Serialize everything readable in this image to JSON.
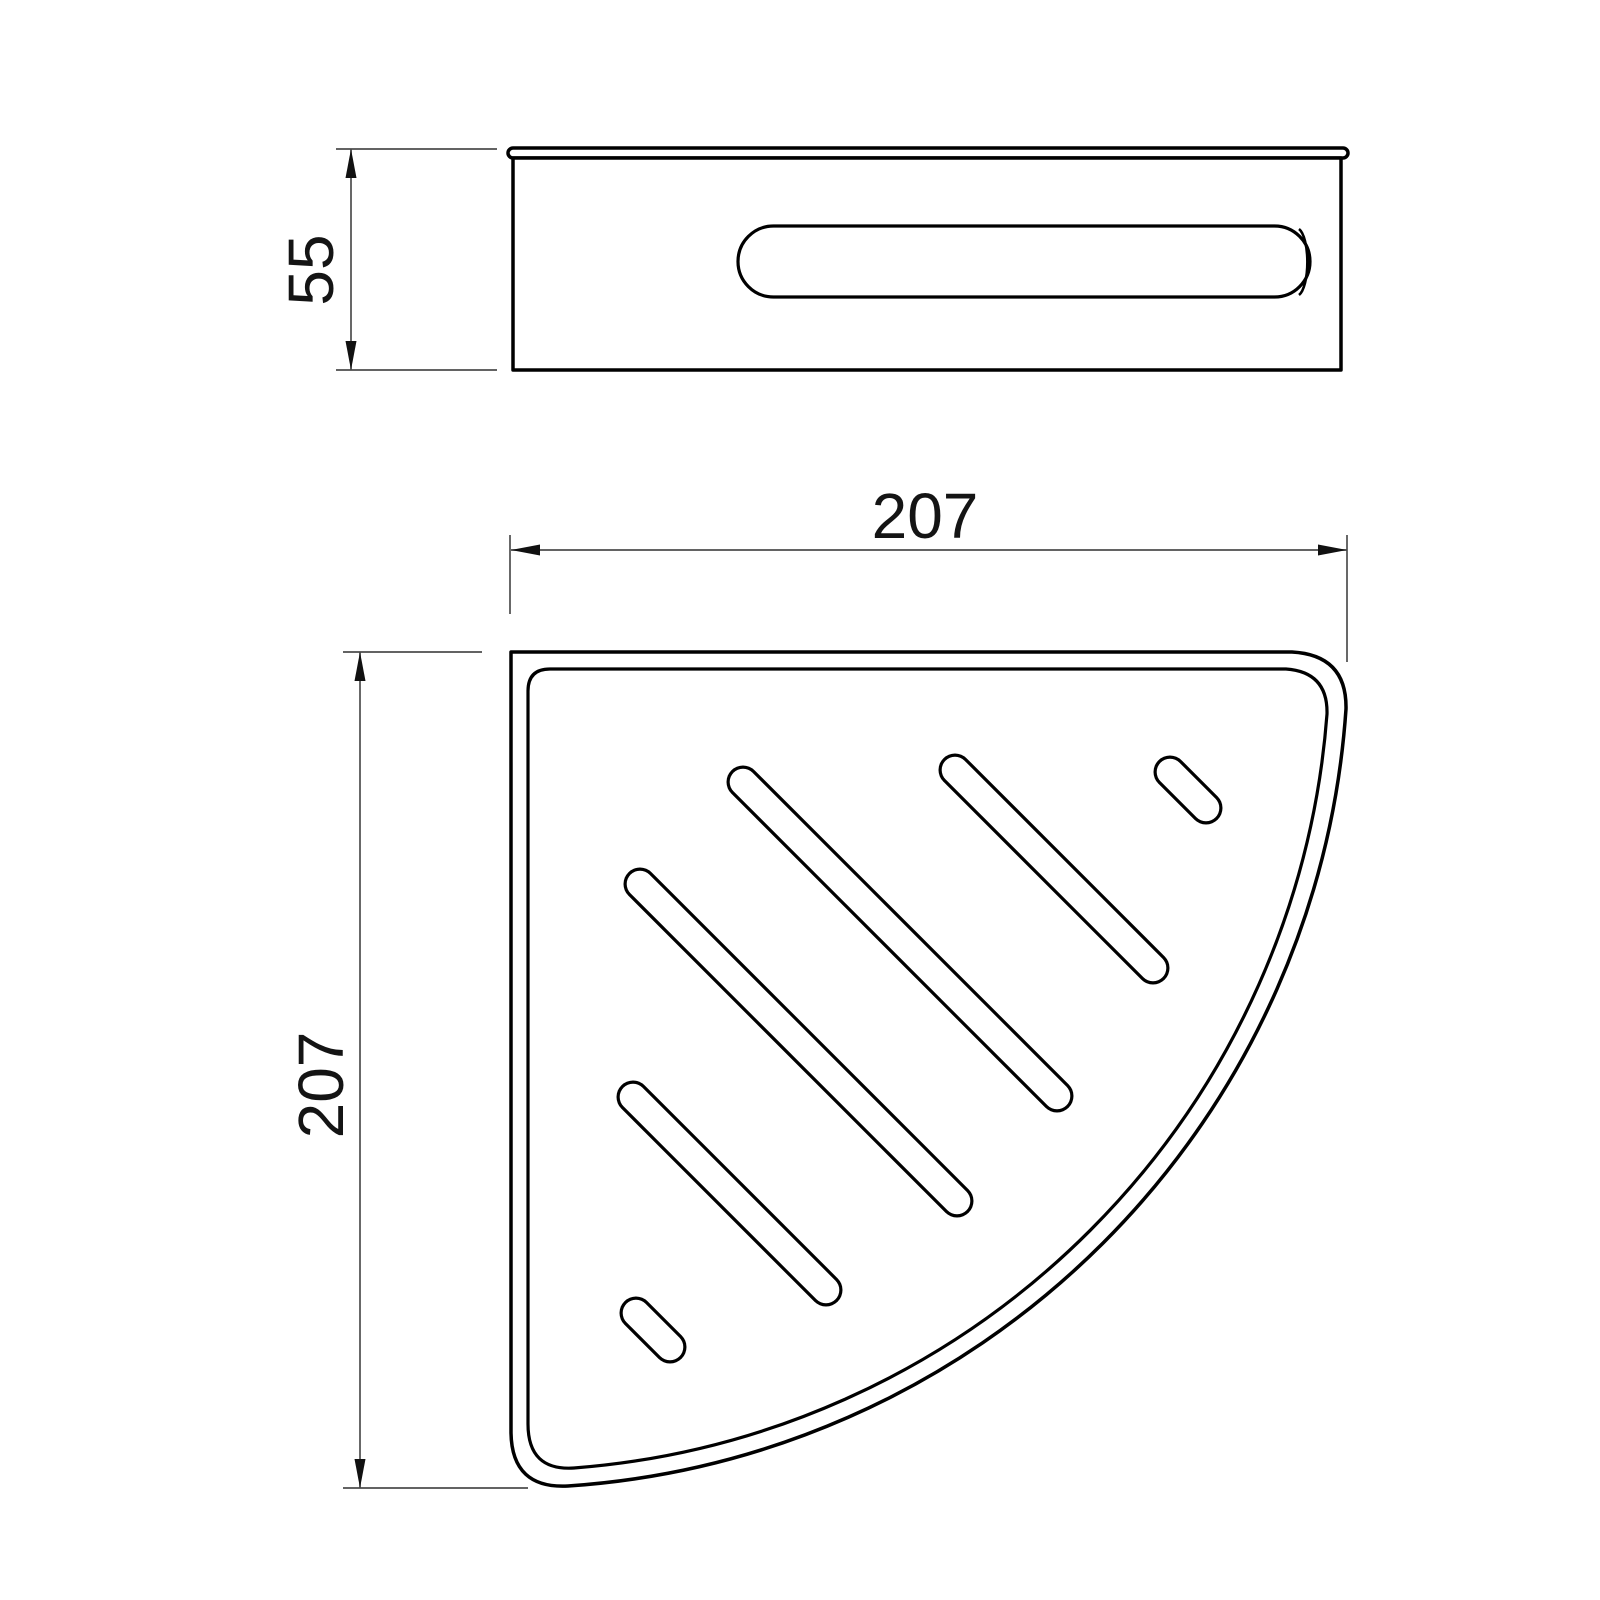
{
  "canvas": {
    "background": "#ffffff",
    "outline_color": "#000000",
    "dimension_line_color": "#4d4d4d",
    "text_color": "#141414"
  },
  "dimensions": {
    "side_height": "55",
    "plan_width": "207",
    "plan_depth": "207"
  }
}
